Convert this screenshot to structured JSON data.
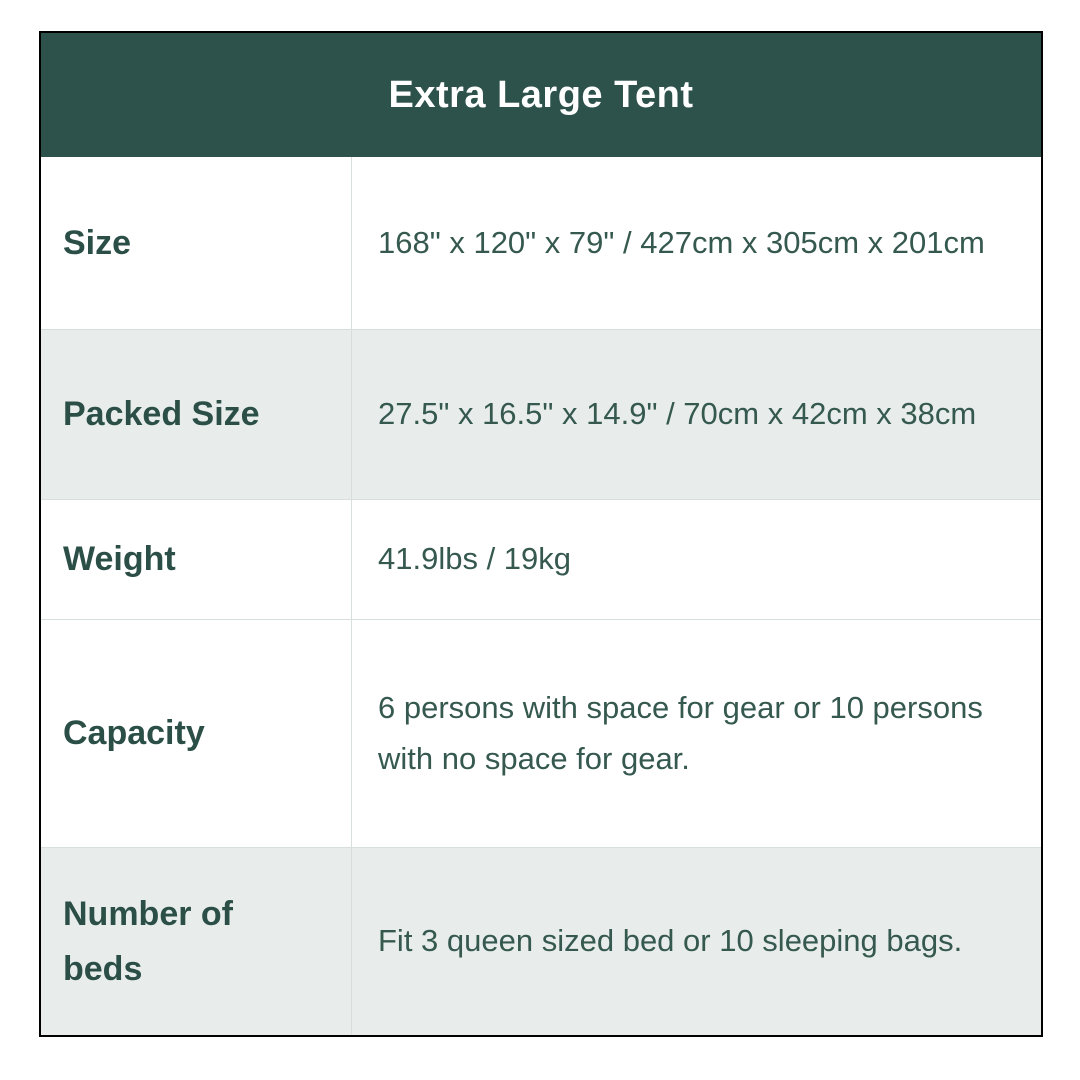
{
  "table": {
    "title": "Extra Large Tent",
    "rows": [
      {
        "label": "Size",
        "value": "168\" x 120\" x 79\" / 427cm x 305cm x 201cm"
      },
      {
        "label": "Packed Size",
        "value": "27.5\" x 16.5\" x 14.9\" / 70cm x 42cm x 38cm"
      },
      {
        "label": "Weight",
        "value": "41.9lbs / 19kg"
      },
      {
        "label": "Capacity",
        "value": "6 persons with space for gear or 10 persons with no space for gear."
      },
      {
        "label": "Number of beds",
        "value": "Fit 3 queen sized bed or 10 sleeping bags."
      }
    ],
    "colors": {
      "header_bg": "#2d524c",
      "header_text": "#ffffff",
      "label_text": "#2b4f47",
      "value_text": "#36594f",
      "shaded_row_bg": "#e8edeb",
      "row_bg": "#ffffff",
      "divider": "#d8dedd",
      "outer_border": "#000000"
    }
  }
}
